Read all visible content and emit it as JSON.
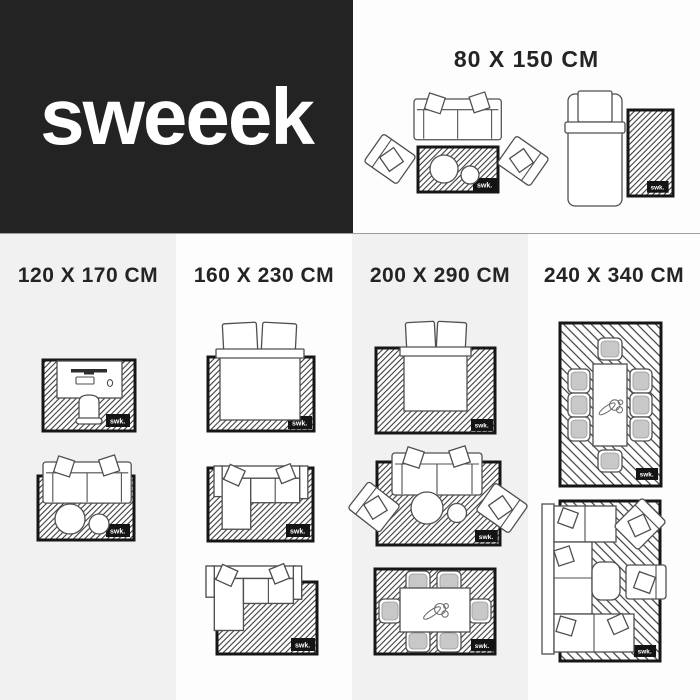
{
  "brand": {
    "logo_text": "sweeek"
  },
  "rug_label": "swk.",
  "colors": {
    "logo_bg": "#232323",
    "gray_panel": "#f1f1f1",
    "white_panel": "#fdfdfd",
    "heading_text": "#242424",
    "rug_border": "#161616",
    "divider_line": "#9e9e9e"
  },
  "top_section": {
    "heading": "80 X 150 CM",
    "scenes": [
      "sofa-two-armchairs-coffee-tables-on-rug",
      "single-bed-beside-rug"
    ]
  },
  "columns": [
    {
      "heading": "120 X 170 CM",
      "scenes": [
        "desk-with-chair-on-rug",
        "sofa-with-coffee-tables-on-rug"
      ]
    },
    {
      "heading": "160 X 230 CM",
      "scenes": [
        "double-bed-on-rug",
        "corner-sofa-on-rug",
        "corner-sofa-partially-on-rug"
      ]
    },
    {
      "heading": "200 X 290 CM",
      "scenes": [
        "double-bed-on-rug",
        "sofa-two-armchairs-coffee-tables-on-rug",
        "dining-table-six-chairs-on-rug"
      ]
    },
    {
      "heading": "240 X 340 CM",
      "scenes": [
        "dining-table-eight-chairs-on-rug",
        "sectional-sofa-lounge-on-rug"
      ]
    }
  ]
}
